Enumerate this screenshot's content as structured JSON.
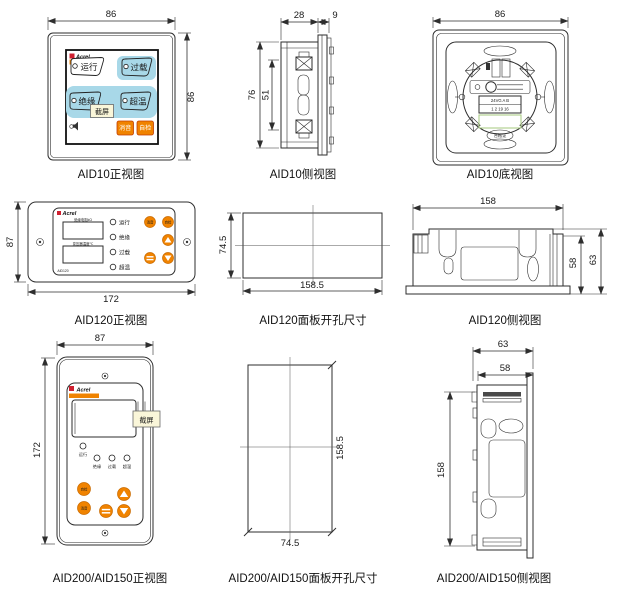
{
  "colors": {
    "accent_orange": "#f08300",
    "button_blue": "#a8d8e8",
    "logo_red": "#cf2030",
    "tag_bg": "#faf6d9",
    "line": "#2e2e2e",
    "green_frame": "#a6c97e"
  },
  "title_captions": {
    "aid10_front": "AID10正视图",
    "aid10_side": "AID10侧视图",
    "aid10_bottom": "AID10底视图",
    "aid120_front": "AID120正视图",
    "aid120_cutout": "AID120面板开孔尺寸",
    "aid120_side": "AID120侧视图",
    "aid200_front": "AID200/AID150正视图",
    "aid200_cutout": "AID200/AID150面板开孔尺寸",
    "aid200_side": "AID200/AID150侧视图"
  },
  "aid10_front": {
    "dim_width": "86",
    "dim_height": "86",
    "brand": "Acrel",
    "model": "AID10",
    "btn_run": "运行",
    "btn_overload": "过载",
    "btn_insulation": "绝缘",
    "btn_overtemp": "超温",
    "btn_mute": "消音",
    "btn_selftest": "自检",
    "tag": "截屏"
  },
  "aid10_side": {
    "dim_depth": "28",
    "dim_panel": "9",
    "dim_height": "76",
    "dim_clip": "51"
  },
  "aid10_bottom": {
    "dim_width": "86",
    "terminal_row1": "24VG A B",
    "terminal_row2": "1 2 19 16",
    "cert_label": "合格证"
  },
  "aid120_front": {
    "dim_height": "87",
    "dim_width": "172",
    "brand": "Acrel",
    "model": "AID120",
    "display1_label": "绝缘电阻kΩ",
    "display2_label": "变压器温度℃",
    "led_run": "运行",
    "led_insulation": "绝缘",
    "led_overload": "过载",
    "led_overtemp": "超温",
    "btn_mute": "消音",
    "btn_selftest": "自检"
  },
  "aid120_cutout": {
    "dim_height": "74.5",
    "dim_width": "158.5"
  },
  "aid120_side": {
    "dim_width": "158",
    "dim_body": "58",
    "dim_total": "63"
  },
  "aid200_front": {
    "dim_width": "87",
    "dim_height": "172",
    "brand": "Acrel",
    "tag": "截屏",
    "led_run": "运行",
    "led_insulation": "绝缘",
    "led_overload": "过载",
    "led_overtemp": "超温",
    "btn_selftest": "自检",
    "btn_mute": "消音"
  },
  "aid200_cutout": {
    "dim_width": "74.5",
    "dim_height": "158.5"
  },
  "aid200_side": {
    "dim_total": "63",
    "dim_body": "58",
    "dim_height": "158"
  }
}
